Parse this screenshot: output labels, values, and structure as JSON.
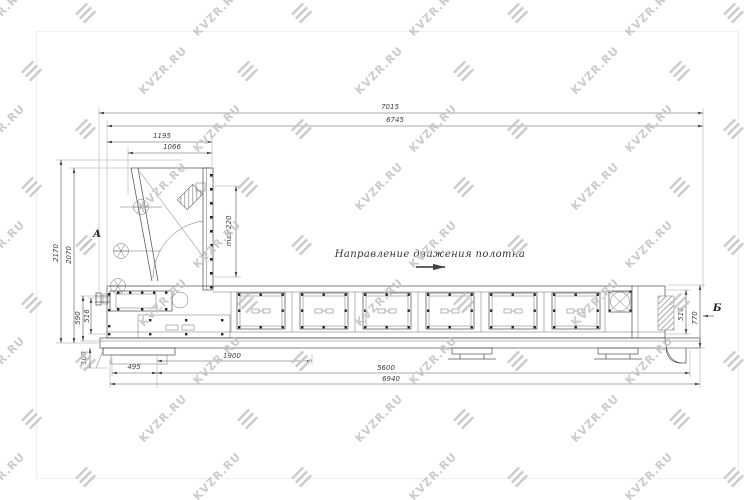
{
  "watermark": {
    "text": "KVZR.RU",
    "color": "#c6c6c6"
  },
  "drawing": {
    "direction_label": "Направление движения полотна",
    "section_a": "А",
    "section_b": "Б",
    "dims": {
      "d7015": "7015",
      "d6745": "6745",
      "d1195": "1195",
      "d1066": "1066",
      "d2170": "2170",
      "d2070": "2070",
      "dmax220": "max 220",
      "d590": "590",
      "d516_left": "516",
      "d100": "100",
      "d495": "495",
      "d1900": "1900",
      "d5600": "5600",
      "d6940": "6940",
      "d516_right": "516",
      "d770": "770"
    },
    "colors": {
      "line": "#565656",
      "extension": "#a3a3a3",
      "watermark": "#c6c6c6"
    }
  }
}
